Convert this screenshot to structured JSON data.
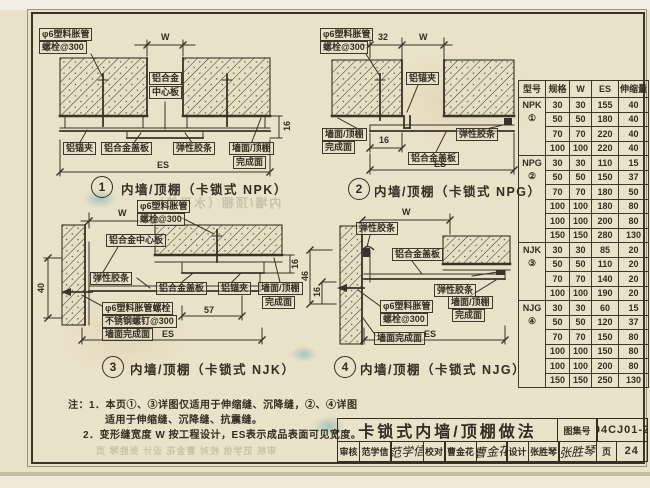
{
  "page": {
    "paper_color": "#eae2c8",
    "ink_color": "#332d23",
    "stamp_color": "#3c96aa"
  },
  "drawings": {
    "d1": {
      "num": "1",
      "caption": "内墙/顶棚（卡锁式 NPK）",
      "anchor_l1": "φ6塑料胀管",
      "anchor_l2": "螺栓@300",
      "center_l1": "铝合金",
      "center_l2": "中心板",
      "clip": "铝锚夹",
      "cover": "铝合金盖板",
      "gasket": "弹性胶条",
      "finish_l1": "墙面/顶棚",
      "finish_l2": "完成面",
      "dim_w": "W",
      "dim_16": "16",
      "dim_es": "ES"
    },
    "d2": {
      "num": "2",
      "caption": "内墙/顶棚（卡锁式 NPG）",
      "anchor_l1": "φ6塑料胀管",
      "anchor_l2": "螺栓@300",
      "clip": "铝锚夹",
      "cover": "铝合金盖板",
      "gasket": "弹性胶条",
      "finish_l1": "墙面/顶棚",
      "finish_l2": "完成面",
      "dim_32": "32",
      "dim_w": "W",
      "dim_16": "16",
      "dim_es": "ES"
    },
    "d3": {
      "num": "3",
      "caption": "内墙/顶棚（卡锁式 NJK）",
      "anchor_l1": "φ6塑料胀管",
      "anchor_l2": "螺栓@300",
      "center": "铝合金中心板",
      "gasket": "弹性胶条",
      "cover": "铝合金盖板",
      "clip": "铝锚夹",
      "finish_l1": "墙面/顶棚",
      "finish_l2": "完成面",
      "bolt_l1": "φ6塑料胀管螺栓",
      "bolt_l2": "不锈钢螺钉@300",
      "bolt_l3": "墙面完成面",
      "dim_w": "W",
      "dim_40": "40",
      "dim_16": "16",
      "dim_57": "57",
      "dim_es": "ES"
    },
    "d4": {
      "num": "4",
      "caption": "内墙/顶棚（卡锁式 NJG）",
      "gasket_top": "弹性胶条",
      "cover": "铝合金盖板",
      "gasket_right": "弹性胶条",
      "anchor_l1": "φ6塑料胀管",
      "anchor_l2": "螺栓@300",
      "wall_finish": "墙面完成面",
      "finish_l1": "墙面/顶棚",
      "finish_l2": "完成面",
      "dim_w": "W",
      "dim_46": "46",
      "dim_16": "16",
      "dim_es": "ES"
    }
  },
  "table": {
    "headers": [
      "型号",
      "规格",
      "W",
      "ES",
      "伸缩量"
    ],
    "groups": [
      {
        "type": "NPK",
        "mark": "①",
        "rows": [
          [
            "30",
            "30",
            "155",
            "40"
          ],
          [
            "50",
            "50",
            "180",
            "40"
          ],
          [
            "70",
            "70",
            "220",
            "40"
          ],
          [
            "100",
            "100",
            "220",
            "40"
          ]
        ]
      },
      {
        "type": "NPG",
        "mark": "②",
        "rows": [
          [
            "30",
            "30",
            "110",
            "15"
          ],
          [
            "50",
            "50",
            "150",
            "37"
          ],
          [
            "70",
            "70",
            "180",
            "50"
          ],
          [
            "100",
            "100",
            "180",
            "80"
          ],
          [
            "100",
            "100",
            "200",
            "80"
          ],
          [
            "150",
            "150",
            "280",
            "130"
          ]
        ]
      },
      {
        "type": "NJK",
        "mark": "③",
        "rows": [
          [
            "30",
            "30",
            "85",
            "20"
          ],
          [
            "50",
            "50",
            "110",
            "20"
          ],
          [
            "70",
            "70",
            "140",
            "20"
          ],
          [
            "100",
            "100",
            "190",
            "20"
          ]
        ]
      },
      {
        "type": "NJG",
        "mark": "④",
        "rows": [
          [
            "30",
            "30",
            "60",
            "15"
          ],
          [
            "50",
            "50",
            "120",
            "37"
          ],
          [
            "70",
            "70",
            "150",
            "80"
          ],
          [
            "100",
            "100",
            "150",
            "80"
          ],
          [
            "100",
            "100",
            "200",
            "80"
          ],
          [
            "150",
            "150",
            "250",
            "130"
          ]
        ]
      }
    ]
  },
  "notes": {
    "line1": "注：1．本页①、③详图仅适用于伸缩缝、沉降缝，②、④详图",
    "line2": "适用于伸缩缝、沉降缝、抗震缝。",
    "line3": "2．变形缝宽度 W 按工程设计，ES表示成品表面可见宽度。"
  },
  "titleblock": {
    "title": "卡锁式内墙/顶棚做法",
    "atlas_label": "图集号",
    "atlas_no": "04CJ01-2",
    "reviewer_label": "审核",
    "reviewer": "范学信",
    "reviewer_sig": "范学信",
    "checker_label": "校对",
    "checker": "曹金花",
    "checker_sig": "曹金花",
    "designer_label": "设计",
    "designer": "张胜琴",
    "designer_sig": "张胜琴",
    "page_label": "页",
    "page_no": "24"
  },
  "artifacts": {
    "ghost_caption": "内墙/顶棚（水平缝）",
    "ghost_titleblock": "审核 范学信 校对 曹金花 设计 张胜琴 页"
  }
}
